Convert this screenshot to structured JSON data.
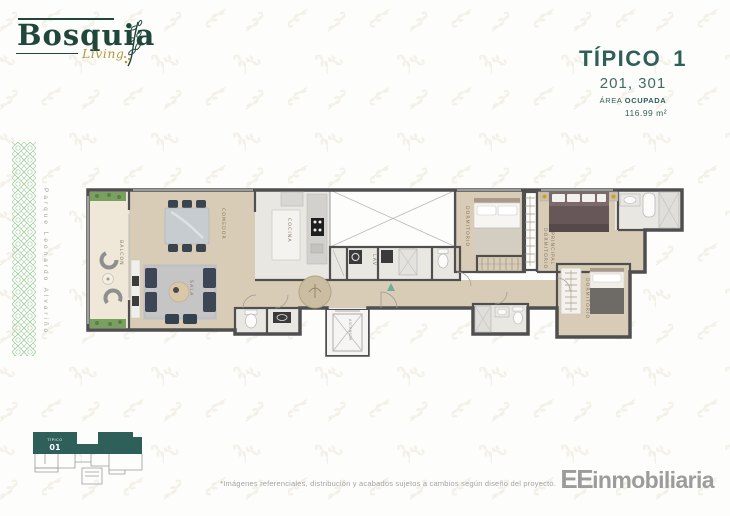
{
  "brand": {
    "name": "Bosquia",
    "tagline": "Living"
  },
  "title_block": {
    "type_label": "TÍPICO",
    "type_number": "1",
    "units": "201, 301",
    "area_label": "ÁREA",
    "area_label_bold": "OCUPADA",
    "area_value": "116.99 m²"
  },
  "left_band": {
    "vertical_text": "Parque Leonardo Alvariño"
  },
  "floorplan": {
    "labels": {
      "balcon": "BALCON",
      "comedor": "COMEDOR",
      "sala": "SALA",
      "cocina": "COCINA",
      "lav": "LAV",
      "ascensor": "ASCENSOR",
      "dormitorio_top": "DORMITORIO",
      "dormitorio_principal_line1": "DORMITORIO",
      "dormitorio_principal_line2": "PRINCIPAL",
      "dormitorio_right": "DORMITORIO"
    }
  },
  "keyplan": {
    "label_top": "TÍPICO",
    "label_number": "01"
  },
  "footer": {
    "disclaimer": "*Imágenes referenciales, distribución y acabados sujetos a cambios según diseño del proyecto.",
    "brand_bold": "EE",
    "brand_rest": "inmobiliaria"
  },
  "icons": {
    "logo_branch": "leaf-branch",
    "entry_arrow": "triangle-up",
    "ornament_band": "green-lattice"
  },
  "colors": {
    "teal": "#2e5f58",
    "logo_green": "#21473c",
    "gold": "#b5973f",
    "wall": "#4f4f4f",
    "wood": "#d9ccb6",
    "marble": "#e9e7e3",
    "pattern_green": "#8cc48e",
    "gray_text": "#9c9c9c"
  }
}
